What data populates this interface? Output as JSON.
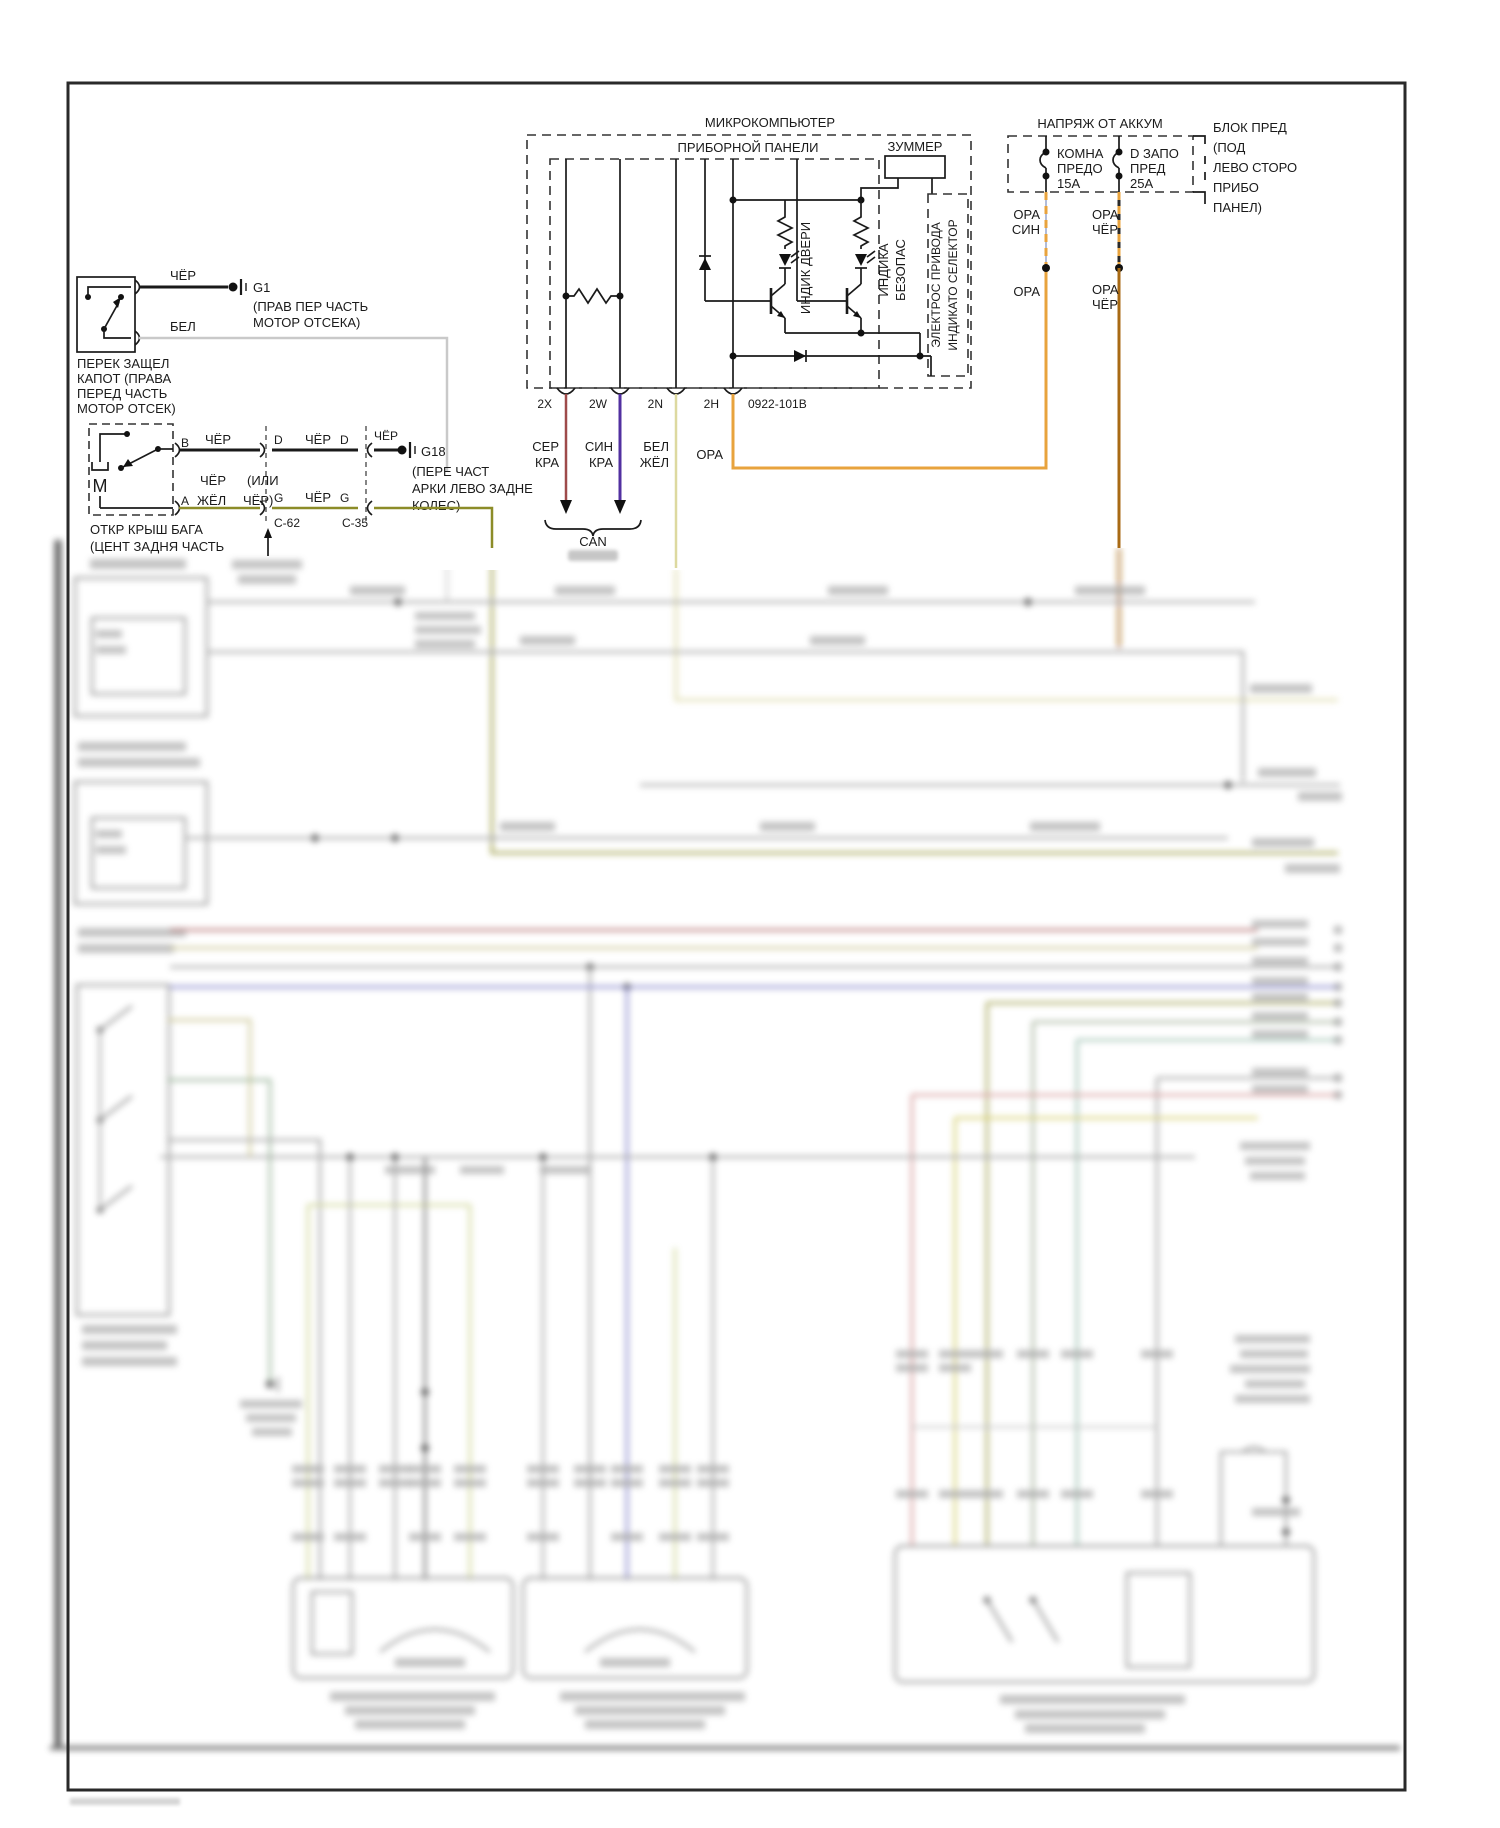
{
  "microcomputer": {
    "title": "МИКРОКОМПЬЮТЕР",
    "subtitle": "ПРИБОРНОЙ ПАНЕЛИ",
    "buzzer": "ЗУММЕР",
    "door_indicator": "ИНДИК ДВЕРИ",
    "safety_indicator": [
      "ИНДИКА",
      "БЕЗОПАС"
    ],
    "selector_drive": [
      "ЭЛЕКТРОС ПРИВОДА",
      "ИНДИКАТО СЕЛЕКТОР"
    ]
  },
  "connector_row": {
    "pin_2x": "2X",
    "pin_2w": "2W",
    "pin_2n": "2N",
    "pin_2h": "2H",
    "code": "0922-101B",
    "w2x": [
      "СЕР",
      "КРА"
    ],
    "w2w": [
      "СИН",
      "КРА"
    ],
    "w2n": [
      "БЕЛ",
      "ЖЁЛ"
    ],
    "w2h": "ОРА",
    "can": "CAN"
  },
  "power": {
    "title": "НАПРЯЖ ОТ АККУМ",
    "fuse1": [
      "КОМНА",
      "ПРЕДО",
      "15А"
    ],
    "fuse2": [
      "D ЗАПО",
      "ПРЕД",
      "25А"
    ],
    "note": [
      "БЛОК ПРЕД",
      "(ПОД",
      "ЛЕВО СТОРО",
      "ПРИБО",
      "ПАНЕЛ)"
    ],
    "w1a": [
      "ОРА",
      "СИН"
    ],
    "w1b": "ОРА",
    "w2a": [
      "ОРА",
      "ЧЁР"
    ],
    "w2b": [
      "ОРА",
      "ЧЁР"
    ]
  },
  "hood_switch": {
    "wire_top": "ЧЁР",
    "ground": "G1",
    "ground_note": [
      "(ПРАВ ПЕР ЧАСТЬ",
      "МОТОР ОТСЕКА)"
    ],
    "wire_bottom": "БЕЛ",
    "label": [
      "ПЕРЕК ЗАЩЕЛ",
      "КАПОТ (ПРАВА",
      "ПЕРЕД ЧАСТЬ",
      "МОТОР ОТСЕК)"
    ]
  },
  "trunk": {
    "motor": "М",
    "pin_b": "B",
    "pin_a": "А",
    "seg1": "ЧЁР",
    "pin_d1": "D",
    "seg2": "ЧЁР",
    "pin_d2": "D",
    "seg3": "ЧЁР",
    "ground": "G18",
    "ground_note": [
      "(ПЕРЕ ЧАСТ",
      "АРКИ ЛЕВО ЗАДНЕ",
      "КОЛЕС)"
    ],
    "alt1a": "ЧЁР",
    "alt1b": "(ИЛИ",
    "alt2a": "ЖЁЛ",
    "alt2b": "ЧЁР)",
    "pin_g1": "G",
    "seg4": "ЧЁР",
    "pin_g2": "G",
    "conn1": "C-62",
    "conn2": "C-35",
    "label": [
      "ОТКР КРЫШ БАГА",
      "(ЦЕНТ ЗАДНЯ ЧАСТЬ"
    ]
  },
  "colors": {
    "orange": "#E8A33D",
    "orange_black": "#A86A14",
    "gray_red": "#9E4A4A",
    "blue_red": "#5230A0",
    "white_yellow": "#DDD9A0",
    "black_yellow": "#8C8C28",
    "white_wire": "#C9C9C9"
  }
}
